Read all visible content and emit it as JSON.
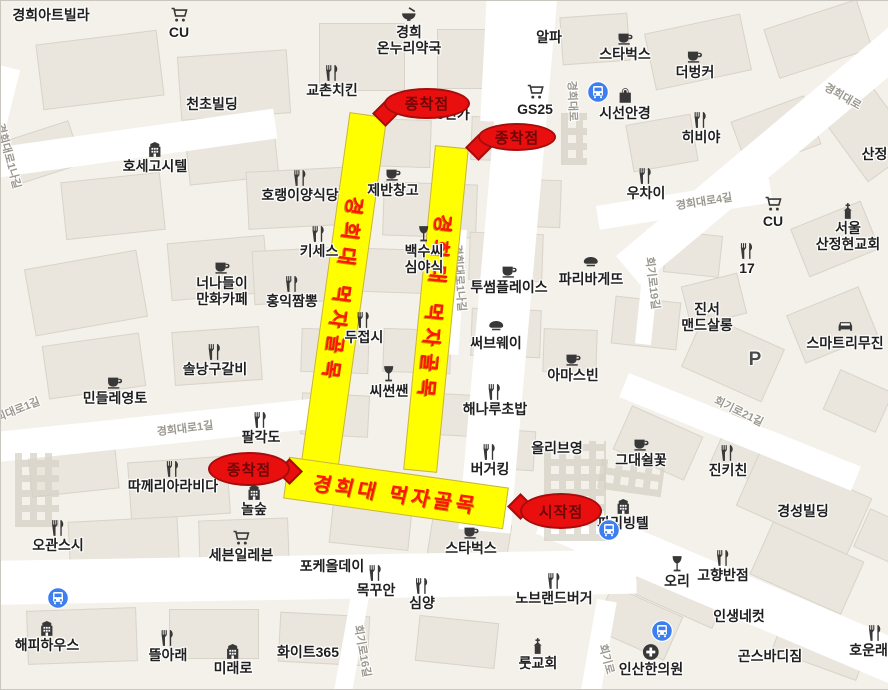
{
  "map": {
    "width": 888,
    "height": 688,
    "colors": {
      "background": "#f4f1ea",
      "road": "#ffffff",
      "building": "#eae6dd",
      "route_highlight": "#ffff00",
      "route_text": "#ff1500",
      "marker_fill": "#e90f0f",
      "marker_text": "#6d0606",
      "poi_text": "#1f1f1f",
      "road_label_text": "#9a988f",
      "transit_blue": "#3d7ff0"
    }
  },
  "route": {
    "label": "경희대 먹자골목",
    "bars": [
      {
        "id": "left-vertical",
        "x": 323.5,
        "y": 111.5,
        "w": 38,
        "h": 355,
        "rot": 7.9,
        "label_rot": 90,
        "skew": 0
      },
      {
        "id": "right-vertical",
        "x": 418,
        "y": 144.5,
        "w": 34,
        "h": 326,
        "rot": 5.6,
        "label_rot": 90,
        "skew": 0
      },
      {
        "id": "bottom-horizontal",
        "x": 283.5,
        "y": 470.5,
        "w": 222,
        "h": 42,
        "rot": 8,
        "label_rot": 0,
        "skew": -6
      }
    ]
  },
  "markers": [
    {
      "label": "종착점",
      "x": 383,
      "y": 87,
      "w": 86,
      "h": 31,
      "tail": "bl"
    },
    {
      "label": "종착점",
      "x": 477,
      "y": 122,
      "w": 78,
      "h": 28,
      "tail": "l"
    },
    {
      "label": "종착점",
      "x": 207,
      "y": 451,
      "w": 82,
      "h": 34,
      "tail": "r"
    },
    {
      "label": "시작점",
      "x": 519,
      "y": 492,
      "w": 82,
      "h": 36,
      "tail": "lt"
    }
  ],
  "pois": [
    {
      "name": "경희아트빌라",
      "icon": null,
      "x": 50,
      "y": 7
    },
    {
      "name": "CU",
      "icon": "cart",
      "x": 178,
      "y": 5
    },
    {
      "name": "경희온누리약국",
      "lines": [
        "경희",
        "온누리약국"
      ],
      "icon": "bowl",
      "x": 408,
      "y": 5
    },
    {
      "name": "알파",
      "icon": null,
      "x": 548,
      "y": 29
    },
    {
      "name": "스타벅스",
      "icon": "cafe",
      "x": 624,
      "y": 27
    },
    {
      "name": "더벙커",
      "icon": "cafe",
      "x": 694,
      "y": 45
    },
    {
      "name": "천초빌딩",
      "icon": null,
      "x": 211,
      "y": 96
    },
    {
      "name": "교촌치킨",
      "icon": "fork",
      "x": 331,
      "y": 63
    },
    {
      "name": "8민가",
      "icon": null,
      "x": 452,
      "y": 106
    },
    {
      "name": "GS25",
      "icon": "cart",
      "x": 534,
      "y": 82
    },
    {
      "name": "시선안경",
      "icon": "bag",
      "x": 624,
      "y": 86
    },
    {
      "name": "히비야",
      "icon": "fork",
      "x": 700,
      "y": 110
    },
    {
      "name": "우차이",
      "icon": "fork",
      "x": 645,
      "y": 166
    },
    {
      "name": "서울산정현교회",
      "lines": [
        "서울",
        "산정현교회"
      ],
      "icon": "church",
      "x": 847,
      "y": 201
    },
    {
      "name": "산정현",
      "icon": null,
      "x": 880,
      "y": 146
    },
    {
      "name": "CU",
      "icon": "cart",
      "x": 772,
      "y": 194
    },
    {
      "name": "호세고시텔",
      "icon": "building",
      "x": 154,
      "y": 139
    },
    {
      "name": "호랭이양식당",
      "icon": "fork",
      "x": 299,
      "y": 168
    },
    {
      "name": "제반창고",
      "icon": "cafe",
      "x": 392,
      "y": 163
    },
    {
      "name": "키세스",
      "icon": "fork",
      "x": 318,
      "y": 224
    },
    {
      "name": "백수씨심야식",
      "lines": [
        "백수씨",
        "심야식"
      ],
      "icon": "wine",
      "x": 423,
      "y": 224
    },
    {
      "name": "너나들이만화카페",
      "lines": [
        "너나들이",
        "만화카페"
      ],
      "icon": "cafe",
      "x": 221,
      "y": 256
    },
    {
      "name": "홍익짬뽕",
      "icon": "fork",
      "x": 291,
      "y": 274
    },
    {
      "name": "투썸플레이스",
      "icon": "cafe",
      "x": 508,
      "y": 260
    },
    {
      "name": "파리바게뜨",
      "icon": "bread",
      "x": 590,
      "y": 252
    },
    {
      "name": "써브웨이",
      "icon": "bread",
      "x": 495,
      "y": 316
    },
    {
      "name": "두접시",
      "icon": "fork",
      "x": 363,
      "y": 310
    },
    {
      "name": "아마스빈",
      "icon": "cafe",
      "x": 572,
      "y": 348
    },
    {
      "name": "씨썬쌘",
      "icon": "wine",
      "x": 388,
      "y": 364
    },
    {
      "name": "해나루초밥",
      "icon": "fork",
      "x": 494,
      "y": 382
    },
    {
      "name": "올리브영",
      "icon": null,
      "x": 556,
      "y": 440
    },
    {
      "name": "버거킹",
      "icon": "fork",
      "x": 489,
      "y": 442
    },
    {
      "name": "솔낭구갈비",
      "icon": "fork",
      "x": 214,
      "y": 342
    },
    {
      "name": "민들레영토",
      "icon": "cafe",
      "x": 114,
      "y": 371
    },
    {
      "name": "팔각도",
      "icon": "fork",
      "x": 260,
      "y": 410
    },
    {
      "name": "따께리아라비다",
      "icon": "fork",
      "x": 172,
      "y": 459
    },
    {
      "name": "놀숲",
      "icon": "building",
      "x": 253,
      "y": 482
    },
    {
      "name": "오관스시",
      "icon": "fork",
      "x": 57,
      "y": 518
    },
    {
      "name": "세븐일레븐",
      "icon": "cart",
      "x": 240,
      "y": 528
    },
    {
      "name": "포케올데이",
      "icon": null,
      "x": 331,
      "y": 558
    },
    {
      "name": "목꾸안",
      "icon": "fork",
      "x": 375,
      "y": 563
    },
    {
      "name": "심양",
      "icon": "fork",
      "x": 421,
      "y": 576
    },
    {
      "name": "스타벅스",
      "icon": "cafe",
      "x": 470,
      "y": 521
    },
    {
      "name": "노브랜드버거",
      "icon": "fork",
      "x": 553,
      "y": 571
    },
    {
      "name": "룻교회",
      "icon": "church",
      "x": 537,
      "y": 636
    },
    {
      "name": "해피하우스",
      "icon": "building",
      "x": 46,
      "y": 618
    },
    {
      "name": "뜰아래",
      "icon": "fork",
      "x": 167,
      "y": 628
    },
    {
      "name": "미래로",
      "icon": "building",
      "x": 232,
      "y": 641
    },
    {
      "name": "화이트365",
      "icon": null,
      "x": 307,
      "y": 644
    },
    {
      "name": "오리",
      "icon": "wine",
      "x": 676,
      "y": 554
    },
    {
      "name": "고향반점",
      "icon": "fork",
      "x": 722,
      "y": 548
    },
    {
      "name": "인생네컷",
      "icon": null,
      "x": 738,
      "y": 608
    },
    {
      "name": "곤스바디짐",
      "icon": null,
      "x": 769,
      "y": 648
    },
    {
      "name": "호운래반",
      "icon": "fork",
      "x": 874,
      "y": 623
    },
    {
      "name": "인산한의원",
      "icon": "hospital",
      "x": 650,
      "y": 642
    },
    {
      "name": "그대쉴꽃",
      "icon": "cafe",
      "x": 640,
      "y": 433
    },
    {
      "name": "진키친",
      "icon": "fork",
      "x": 727,
      "y": 443
    },
    {
      "name": "경성빌딩",
      "icon": null,
      "x": 802,
      "y": 503
    },
    {
      "name": "진서맨드살롱",
      "lines": [
        "진서",
        "맨드살롱"
      ],
      "icon": null,
      "x": 706,
      "y": 301
    },
    {
      "name": "스마트리무진",
      "icon": "car",
      "x": 844,
      "y": 316
    },
    {
      "name": "17",
      "icon": "fork",
      "x": 746,
      "y": 241
    },
    {
      "name": "P",
      "icon": null,
      "x": 754,
      "y": 348,
      "style": "parking"
    },
    {
      "name": "파리빙텔",
      "icon": "building",
      "x": 622,
      "y": 496
    }
  ],
  "road_labels": [
    {
      "text": "경희대로1나길",
      "x": 8,
      "y": 155,
      "rot": 75
    },
    {
      "text": "경희대로1나길",
      "x": 459,
      "y": 277,
      "rot": 86
    },
    {
      "text": "경희대로1길",
      "x": 184,
      "y": 427,
      "rot": -7
    },
    {
      "text": "경희대로1길",
      "x": 12,
      "y": 410,
      "rot": -22
    },
    {
      "text": "경희대로",
      "x": 572,
      "y": 100,
      "rot": 88
    },
    {
      "text": "경희대로4길",
      "x": 703,
      "y": 200,
      "rot": -9
    },
    {
      "text": "경희대로",
      "x": 842,
      "y": 95,
      "rot": 30
    },
    {
      "text": "회기로19길",
      "x": 652,
      "y": 282,
      "rot": 83
    },
    {
      "text": "회기로21길",
      "x": 738,
      "y": 410,
      "rot": 26
    },
    {
      "text": "회기로16길",
      "x": 362,
      "y": 650,
      "rot": 80
    },
    {
      "text": "회기로",
      "x": 606,
      "y": 658,
      "rot": 75
    }
  ],
  "transit_icons": [
    {
      "x": 597,
      "y": 91
    },
    {
      "x": 57,
      "y": 597
    },
    {
      "x": 608,
      "y": 529
    },
    {
      "x": 661,
      "y": 630
    }
  ]
}
